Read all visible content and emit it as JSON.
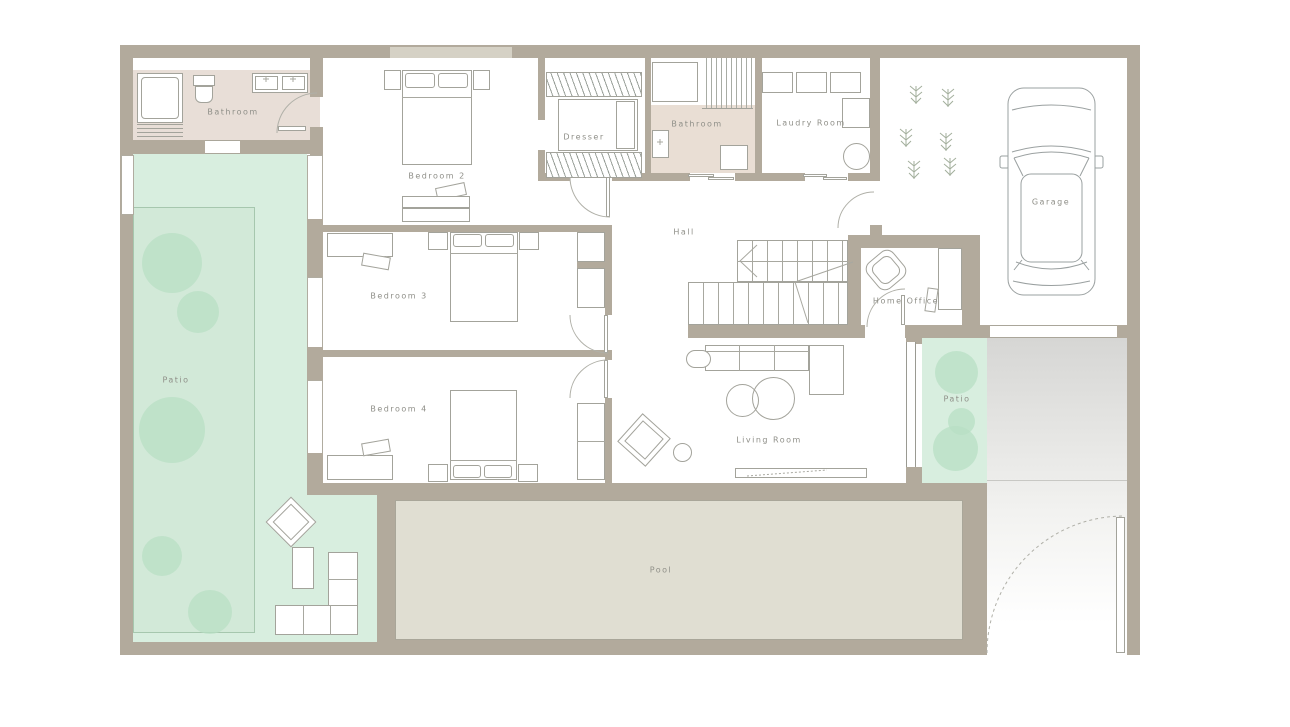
{
  "rooms": {
    "bathroom1": {
      "label": "Bathroom"
    },
    "bedroom2": {
      "label": "Bedroom 2"
    },
    "dresser": {
      "label": "Dresser"
    },
    "bathroom2": {
      "label": "Bathroom"
    },
    "laundry": {
      "label": "Laudry Room"
    },
    "garage": {
      "label": "Garage"
    },
    "hall": {
      "label": "Hall"
    },
    "home_office": {
      "label": "Home Office"
    },
    "bedroom3": {
      "label": "Bedroom 3"
    },
    "bedroom4": {
      "label": "Bedroom 4"
    },
    "patio_left": {
      "label": "Patio"
    },
    "living_room": {
      "label": "Living Room"
    },
    "patio_right": {
      "label": "Patio"
    },
    "pool": {
      "label": "Pool"
    }
  },
  "colors": {
    "wall": "#b2aa9c",
    "bathroom_floor": "#e8ded7",
    "patio_green": "#d8eedf",
    "lawn_green": "#d2e9d8",
    "tree_green": "#b7dfc4",
    "pool_surface": "#e0ded2",
    "driveway_gray": "#d6d6d4",
    "line": "#a3a39b",
    "label_text": "#8f8f88"
  }
}
